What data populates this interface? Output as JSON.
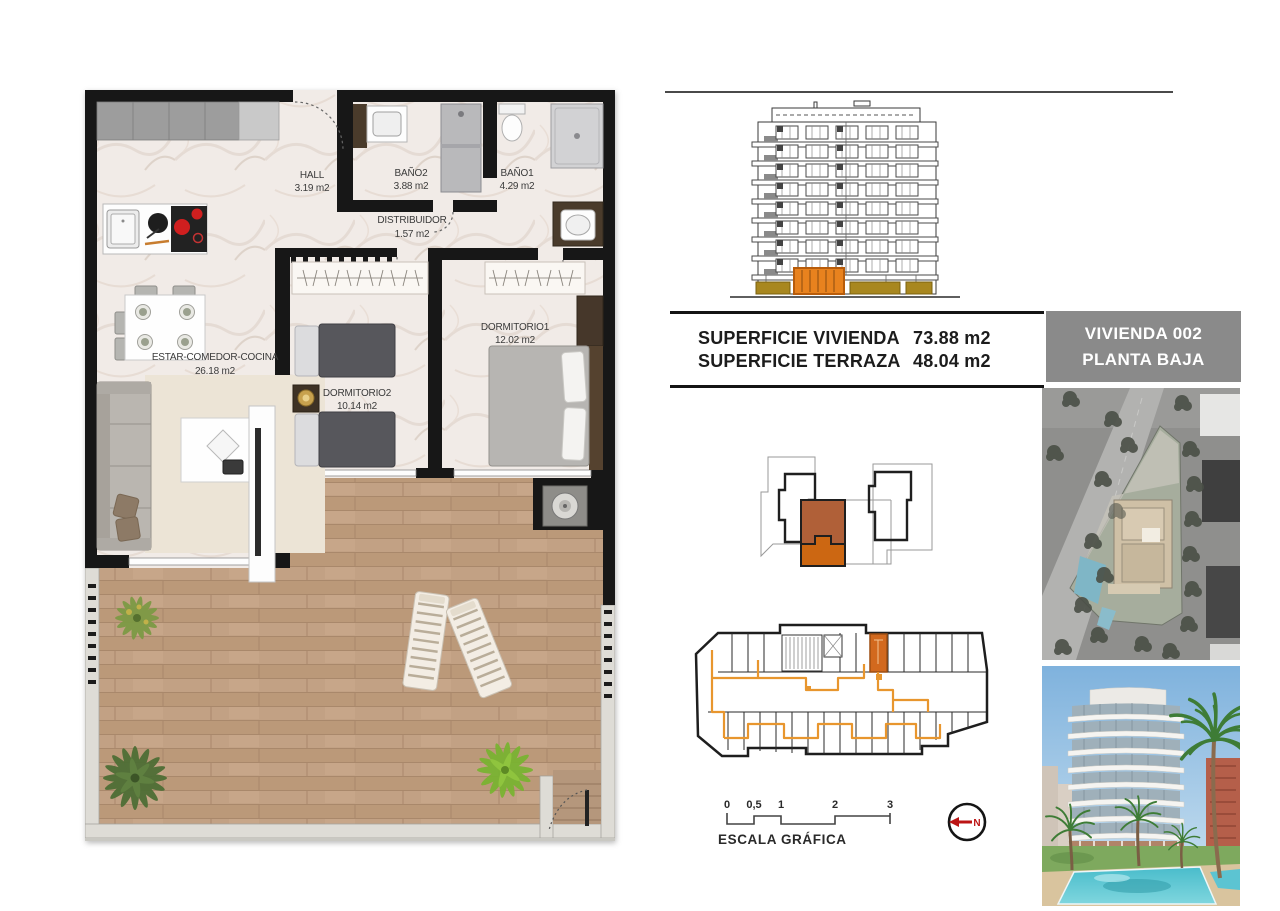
{
  "floor_plan": {
    "rooms": [
      {
        "name": "HALL",
        "area": "3.19 m2"
      },
      {
        "name": "BAÑO2",
        "area": "3.88 m2"
      },
      {
        "name": "BAÑO1",
        "area": "4.29 m2"
      },
      {
        "name": "DISTRIBUIDOR",
        "area": "1.57 m2"
      },
      {
        "name": "ESTAR-COMEDOR-COCINA",
        "area": "26.18 m2"
      },
      {
        "name": "DORMITORIO2",
        "area": "10.14 m2"
      },
      {
        "name": "DORMITORIO1",
        "area": "12.02 m2"
      }
    ]
  },
  "summary_table": {
    "rows": [
      {
        "label": "SUPERFICIE VIVIENDA",
        "value": "73.88 m2"
      },
      {
        "label": "SUPERFICIE TERRAZA",
        "value": "48.04 m2"
      }
    ]
  },
  "unit_badge": {
    "line1": "VIVIENDA 002",
    "line2": "PLANTA BAJA"
  },
  "scale_bar": {
    "ticks": [
      "0",
      "0,5",
      "1",
      "2",
      "3"
    ],
    "caption": "ESCALA GRÁFICA"
  },
  "north_arrow": {
    "label": "N"
  },
  "colors": {
    "highlight_orange": "#cc6712",
    "highlight_sienna": "#b06038",
    "elevation_orange": "#e8821e",
    "elevation_ochre": "#a8871f",
    "badge_gray": "#8a8a8a",
    "wood": "#c2a184",
    "marble": "#f1ebe7",
    "route_orange": "#e8962e",
    "north_red": "#bb1414"
  }
}
